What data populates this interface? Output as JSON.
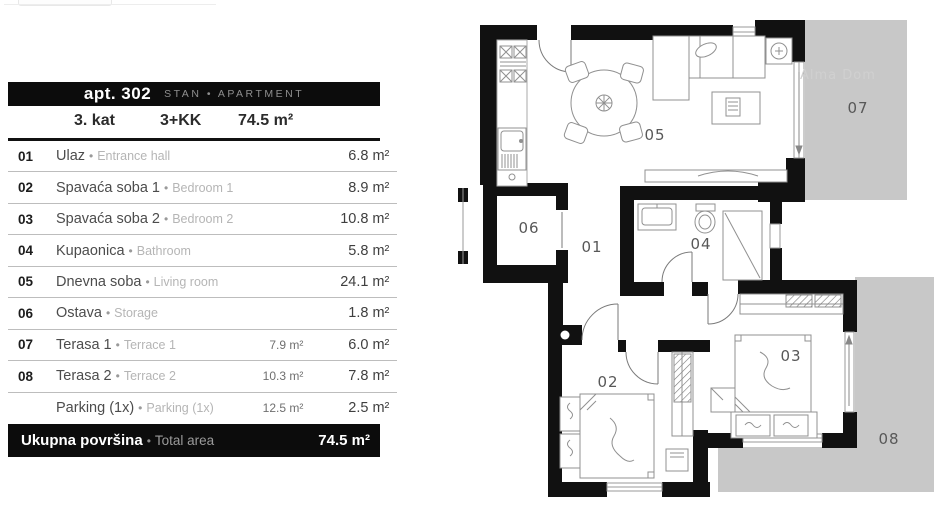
{
  "ui": {
    "bullet": "•"
  },
  "header": {
    "apt_label": "apt. 302",
    "type_label": "STAN • APARTMENT",
    "floor": "3. kat",
    "layout": "3+KK",
    "area": "74.5 m²"
  },
  "rooms": [
    {
      "num": "01",
      "name": "Ulaz",
      "name_en": "Entrance hall",
      "mid": "",
      "area": "6.8 m²"
    },
    {
      "num": "02",
      "name": "Spavaća soba 1",
      "name_en": "Bedroom 1",
      "mid": "",
      "area": "8.9 m²"
    },
    {
      "num": "03",
      "name": "Spavaća soba 2",
      "name_en": "Bedroom 2",
      "mid": "",
      "area": "10.8 m²"
    },
    {
      "num": "04",
      "name": "Kupaonica",
      "name_en": "Bathroom",
      "mid": "",
      "area": "5.8 m²"
    },
    {
      "num": "05",
      "name": "Dnevna soba",
      "name_en": "Living room",
      "mid": "",
      "area": "24.1 m²"
    },
    {
      "num": "06",
      "name": "Ostava",
      "name_en": "Storage",
      "mid": "",
      "area": "1.8 m²"
    },
    {
      "num": "07",
      "name": "Terasa 1",
      "name_en": "Terrace 1",
      "mid": "7.9 m²",
      "area": "6.0 m²"
    },
    {
      "num": "08",
      "name": "Terasa 2",
      "name_en": "Terrace 2",
      "mid": "10.3 m²",
      "area": "7.8 m²"
    },
    {
      "num": "",
      "name": "Parking (1x)",
      "name_en": "Parking (1x)",
      "mid": "12.5 m²",
      "area": "2.5 m²"
    }
  ],
  "total": {
    "label": "Ukupna površina",
    "label_en": "Total area",
    "value": "74.5 m²"
  },
  "plan": {
    "room_01": "01",
    "room_02": "02",
    "room_03": "03",
    "room_04": "04",
    "room_05": "05",
    "room_06": "06",
    "room_07": "07",
    "room_08": "08",
    "shaft": "A",
    "watermark": "Alma Dom"
  },
  "colors": {
    "bar_black": "#0c0c0c",
    "wall_black": "#111111",
    "terrace_gray": "#c8c8c8",
    "furniture_line": "#909090",
    "label_gray": "#585858"
  }
}
